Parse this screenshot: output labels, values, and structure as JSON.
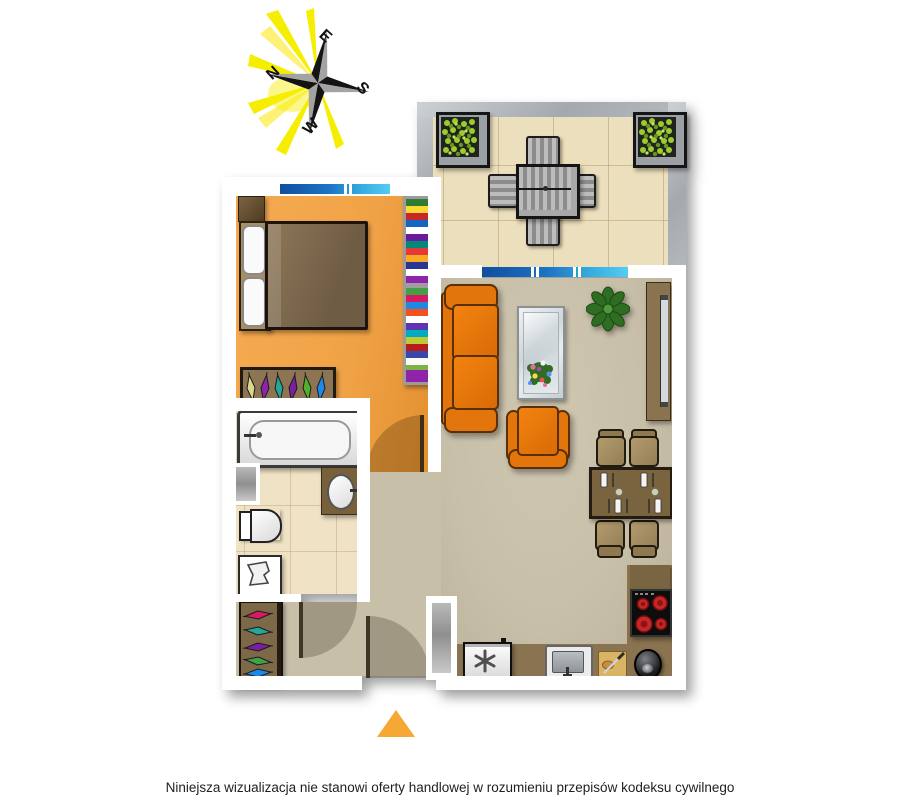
{
  "compass": {
    "north": "N",
    "east": "E",
    "south": "S",
    "west": "W"
  },
  "disclaimer": {
    "text": "Niniejsza wizualizacja nie stanowi oferty handlowej w rozumieniu przepisów kodeksu cywilnego"
  },
  "colors": {
    "wall": "#ffffff",
    "balcony_wall": "#a4a9ae",
    "bedroom_floor": "#f2a64b",
    "living_floor": "#c8bfa9",
    "bathroom_floor": "#f0e2c4",
    "balcony_floor": "#ecdfbd",
    "window_blue_dark": "#0f4f9e",
    "window_blue_light": "#55ccf2",
    "sofa_orange": "#e2750c",
    "kitchen_counter": "#8a7350",
    "entrance_arrow": "#f5a834",
    "compass_rays": "#f6ee00"
  },
  "rooms": {
    "bedroom": {
      "furniture": [
        "double-bed",
        "nightstand",
        "bookshelf",
        "wardrobe",
        "window"
      ]
    },
    "bathroom": {
      "furniture": [
        "bathtub",
        "washbasin-vanity",
        "toilet",
        "laundry-basket",
        "radiator-niche"
      ]
    },
    "living_room": {
      "furniture": [
        "sofa",
        "armchair",
        "coffee-table-with-flowers",
        "potted-plant",
        "tv-board",
        "dining-table",
        "dining-chairs"
      ]
    },
    "kitchen": {
      "furniture": [
        "fridge-freezer",
        "kitchen-sink",
        "cutting-board",
        "pot",
        "stove-hob",
        "counter"
      ]
    },
    "hall": {
      "furniture": [
        "wardrobe",
        "entrance-door"
      ]
    },
    "balcony": {
      "furniture": [
        "planter-left",
        "planter-right",
        "garden-table",
        "garden-chairs"
      ]
    }
  }
}
